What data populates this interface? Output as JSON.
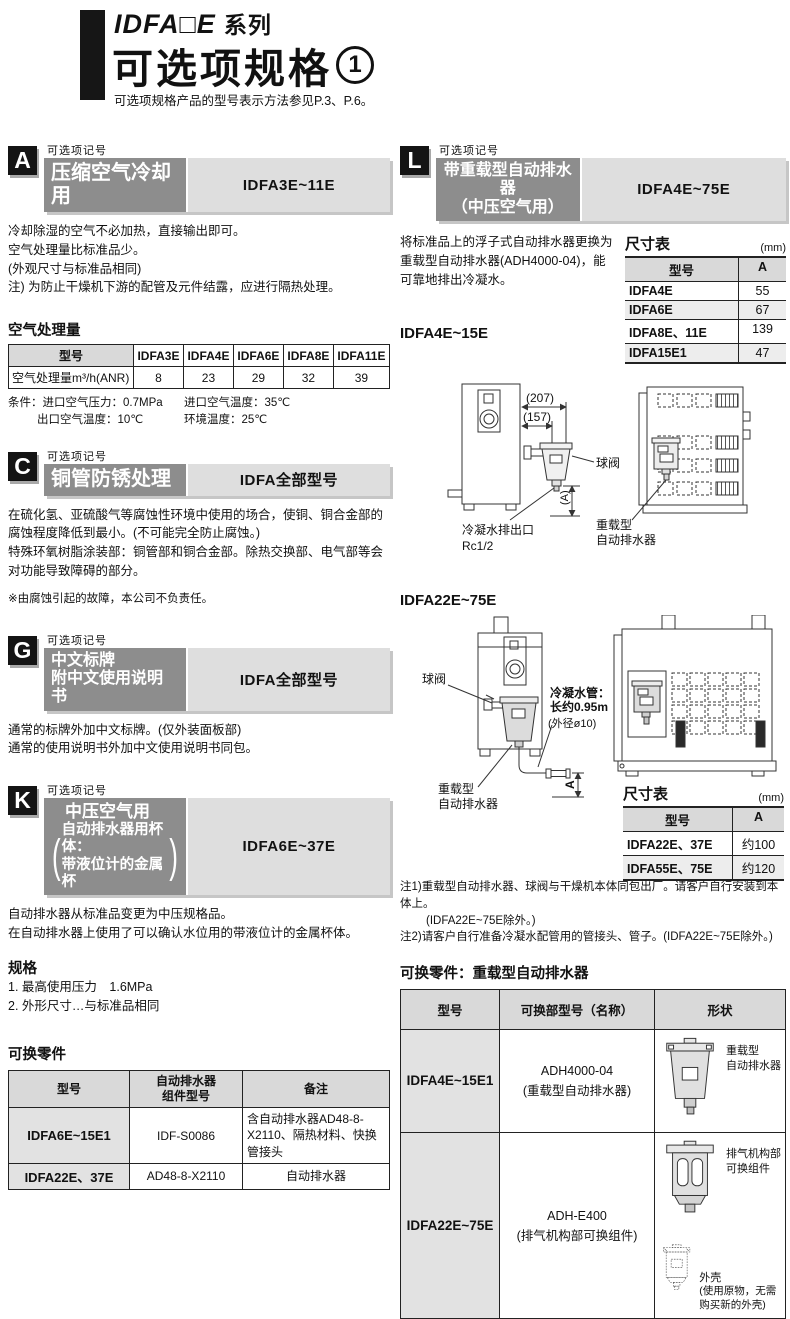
{
  "header": {
    "series": "IDFA□E",
    "series_suffix": "系列",
    "title": "可选项规格",
    "title_circ": "1",
    "note": "可选项规格产品的型号表示方法参见P.3、P.6。"
  },
  "common": {
    "option_mark": "可选项记号",
    "dim_table": "尺寸表",
    "mm": "(mm)",
    "model": "型号",
    "col_a": "A",
    "paren_l": "(",
    "paren_r": ")"
  },
  "a": {
    "badge": "A",
    "title": "压缩空气冷却用",
    "models": "IDFA3E~11E",
    "p1": "冷却除湿的空气不必加热，直接输出即可。",
    "p2": "空气处理量比标准品少。",
    "p3": "(外观尺寸与标准品相同)",
    "p4": "注) 为防止干燥机下游的配管及元件结露，应进行隔热处理。",
    "flow_title": "空气处理量",
    "row_label": "空气处理量m³/h(ANR)",
    "models_list": [
      "IDFA3E",
      "IDFA4E",
      "IDFA6E",
      "IDFA8E",
      "IDFA11E"
    ],
    "values": [
      "8",
      "23",
      "29",
      "32",
      "39"
    ],
    "cond1a": "条件：进口空气压力：0.7MPa",
    "cond1b": "进口空气温度：35℃",
    "cond2a": "出口空气温度：10℃",
    "cond2b": "环境温度：25℃"
  },
  "c": {
    "badge": "C",
    "title": "铜管防锈处理",
    "models": "IDFA全部型号",
    "p1": "在硫化氢、亚硫酸气等腐蚀性环境中使用的场合，使铜、铜合金部的腐蚀程度降低到最小。(不可能完全防止腐蚀。)",
    "p2": "特殊环氧树脂涂装部：铜管部和铜合金部。除热交换部、电气部等会对功能导致障碍的部分。",
    "note": "※由腐蚀引起的故障，本公司不负责任。"
  },
  "g": {
    "badge": "G",
    "title1": "中文标牌",
    "title2": "附中文使用说明书",
    "models": "IDFA全部型号",
    "p1": "通常的标牌外加中文标牌。(仅外装面板部)",
    "p2": "通常的使用说明书外加中文使用说明书同包。"
  },
  "k": {
    "badge": "K",
    "title1": "中压空气用",
    "title2": "自动排水器用杯体：",
    "title3": "带液位计的金属杯",
    "models": "IDFA6E~37E",
    "p1": "自动排水器从标准品变更为中压规格品。",
    "p2": "在自动排水器上使用了可以确认水位用的带液位计的金属杯体。",
    "spec_title": "规格",
    "spec1": "1. 最高使用压力　1.6MPa",
    "spec2": "2. 外形尺寸…与标准品相同"
  },
  "parts_left": {
    "title": "可换零件",
    "h1": "型号",
    "h2": "自动排水器\n组件型号",
    "h3": "备注",
    "rows": [
      {
        "model": "IDFA6E~15E1",
        "part": "IDF-S0086",
        "note": "含自动排水器AD48-8-X2110、隔热材料、快换管接头"
      },
      {
        "model": "IDFA22E、37E",
        "part": "AD48-8-X2110",
        "note": "自动排水器"
      }
    ]
  },
  "l": {
    "badge": "L",
    "title1": "带重载型自动排水器",
    "title2": "（中压空气用）",
    "models": "IDFA4E~75E",
    "body": "将标准品上的浮子式自动排水器更换为重载型自动排水器(ADH4000-04)，能可靠地排出冷凝水。",
    "sub1": "IDFA4E~15E",
    "sub2": "IDFA22E~75E",
    "dim1_rows": [
      {
        "model": "IDFA4E",
        "a": "55"
      },
      {
        "model": "IDFA6E",
        "a": "67"
      },
      {
        "model": "IDFA8E、11E",
        "a": "139"
      },
      {
        "model": "IDFA15E1",
        "a": "47"
      }
    ],
    "dim2_rows": [
      {
        "model": "IDFA22E、37E",
        "a": "约100"
      },
      {
        "model": "IDFA55E、75E",
        "a": "约120"
      }
    ],
    "d1": {
      "dim207": "(207)",
      "dim157": "(157)",
      "ball_valve": "球阀",
      "dimA": "(A)",
      "drain_out": "冷凝水排出口",
      "rc": "Rc1/2",
      "hd1": "重载型",
      "hd2": "自动排水器"
    },
    "d2": {
      "ball_valve": "球阀",
      "tube1": "冷凝水管：",
      "tube2": "长约0.95m",
      "tube3": "(外径ø10)",
      "dimA": "A",
      "hd1": "重载型",
      "hd2": "自动排水器"
    },
    "note1": "注1)重载型自动排水器、球阀与干燥机本体同包出厂。请客户自行安装到本体上。",
    "note1b": "(IDFA22E~75E除外。)",
    "note2": "注2)请客户自行准备冷凝水配管用的管接头、管子。(IDFA22E~75E除外。)"
  },
  "parts_right": {
    "title": "可换零件：重载型自动排水器",
    "h1": "型号",
    "h2": "可换部型号（名称）",
    "h3": "形状",
    "rows": [
      {
        "model": "IDFA4E~15E1",
        "part": "ADH4000-04",
        "part2": "(重载型自动排水器)",
        "lbl1": "重载型",
        "lbl2": "自动排水器"
      },
      {
        "model": "IDFA22E~75E",
        "part": "ADH-E400",
        "part2": "(排气机构部可换组件)",
        "lbl1": "排气机构部",
        "lbl2": "可换组件",
        "lbl3": "外壳",
        "lbl4": "(使用原物，无需购买新的外壳)"
      }
    ]
  }
}
